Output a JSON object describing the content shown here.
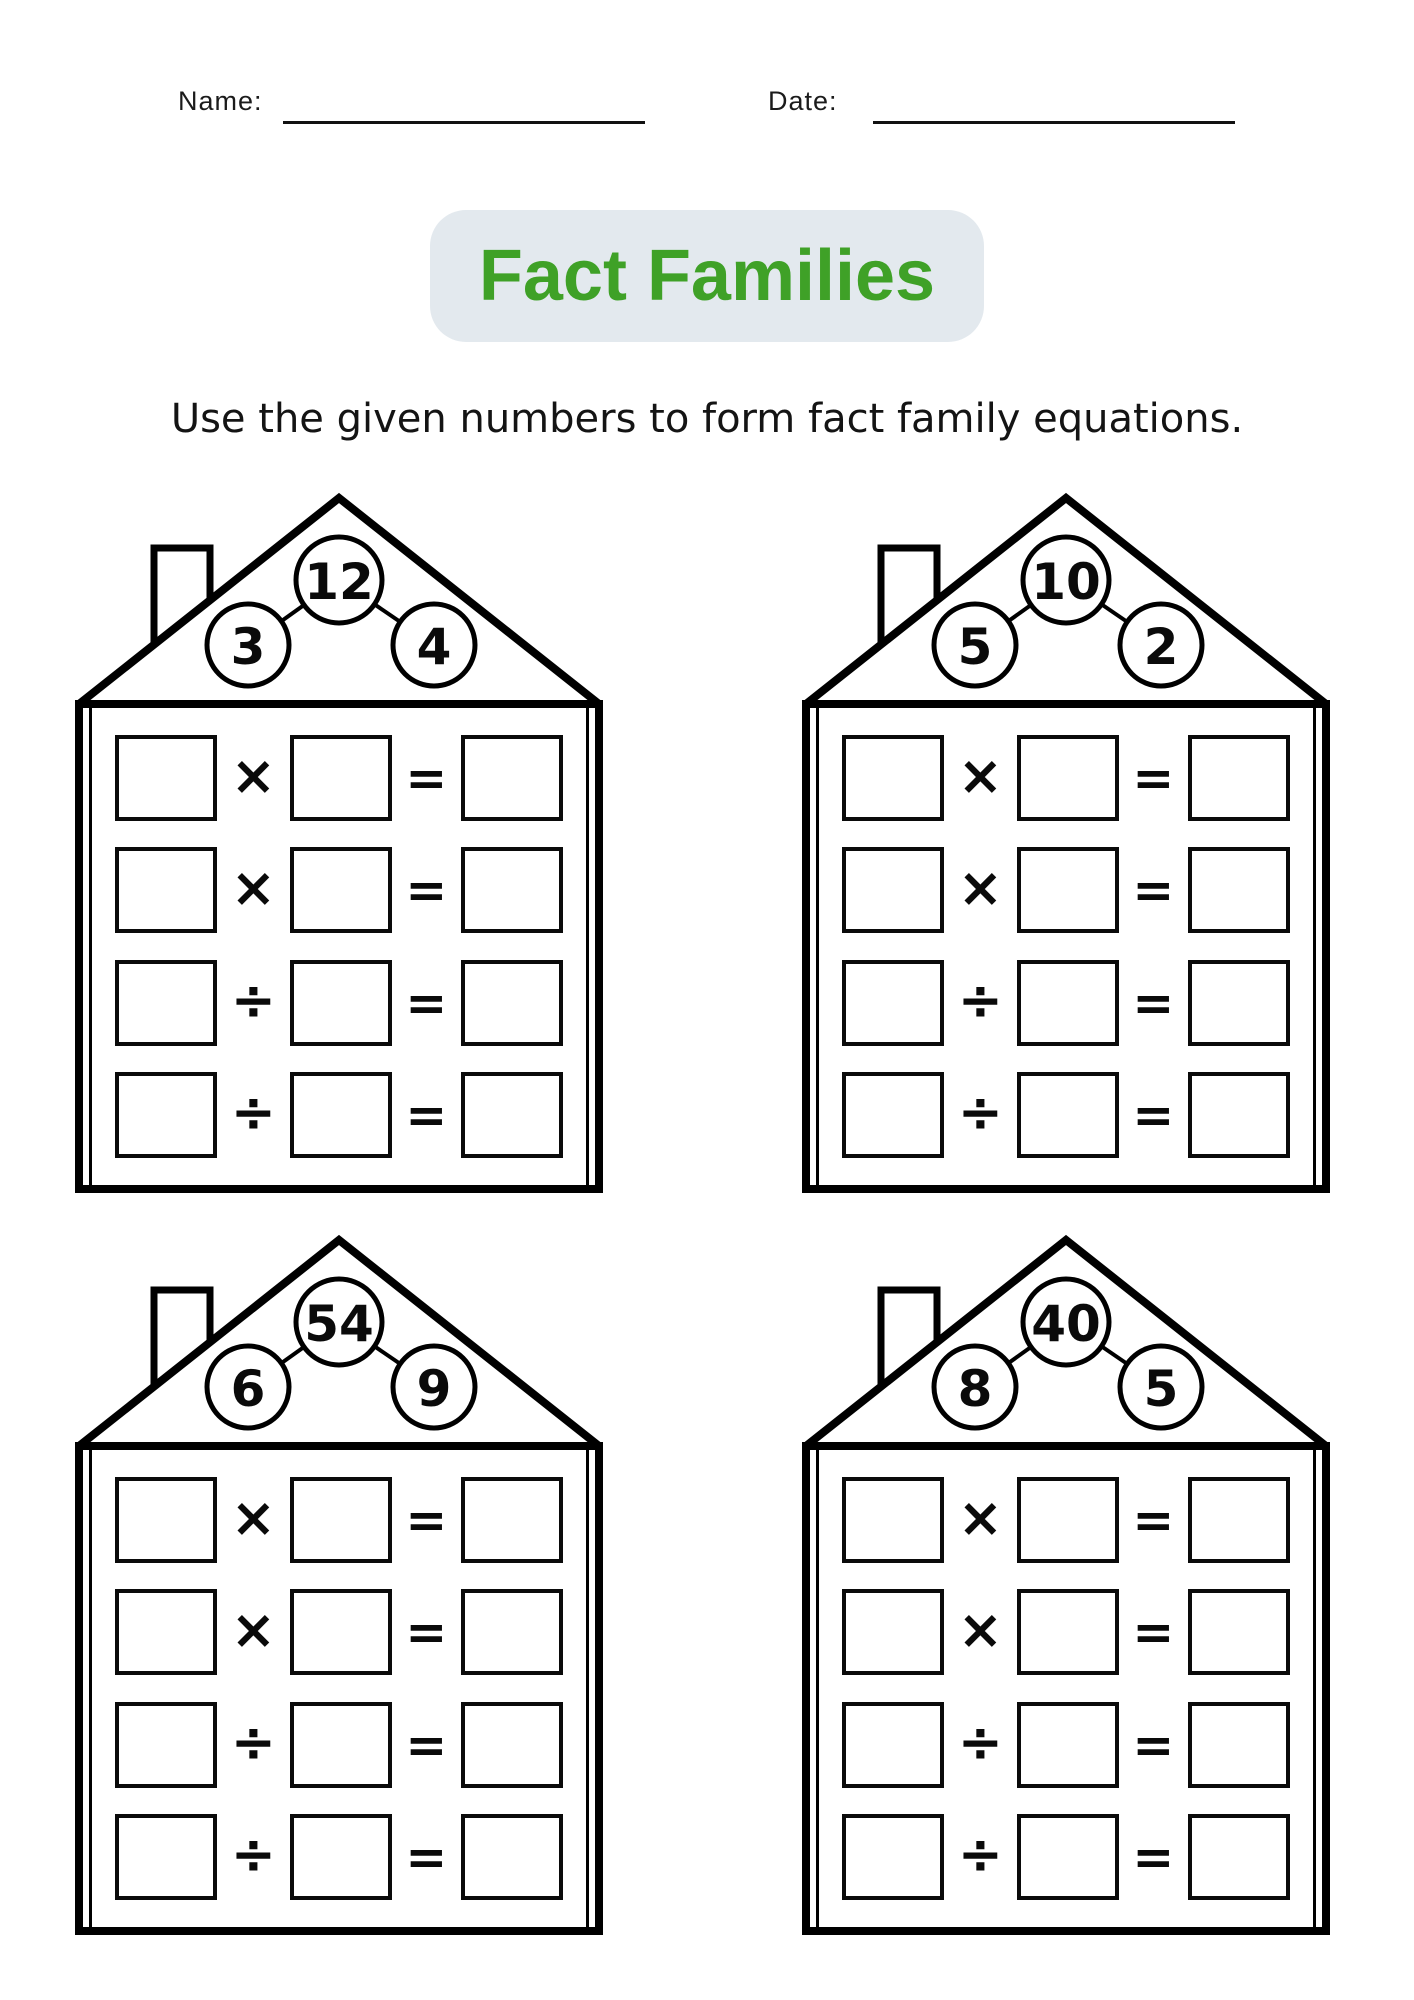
{
  "header": {
    "name_label": "Name:",
    "date_label": "Date:"
  },
  "title": {
    "text": "Fact Families"
  },
  "instruction": "Use the given numbers to form fact family equations.",
  "symbols": {
    "multiply": "×",
    "divide": "÷",
    "equals": "="
  },
  "rows": [
    {
      "op": "×"
    },
    {
      "op": "×"
    },
    {
      "op": "÷"
    },
    {
      "op": "÷"
    }
  ],
  "houses": [
    {
      "top_number": "12",
      "left_number": "3",
      "right_number": "4"
    },
    {
      "top_number": "10",
      "left_number": "5",
      "right_number": "2"
    },
    {
      "top_number": "54",
      "left_number": "6",
      "right_number": "9"
    },
    {
      "top_number": "40",
      "left_number": "8",
      "right_number": "5"
    }
  ],
  "colors": {
    "title_green": "#3FA127",
    "pill_background": "#E3E9EE",
    "ink": "#000000",
    "page_background": "#FFFFFF"
  }
}
